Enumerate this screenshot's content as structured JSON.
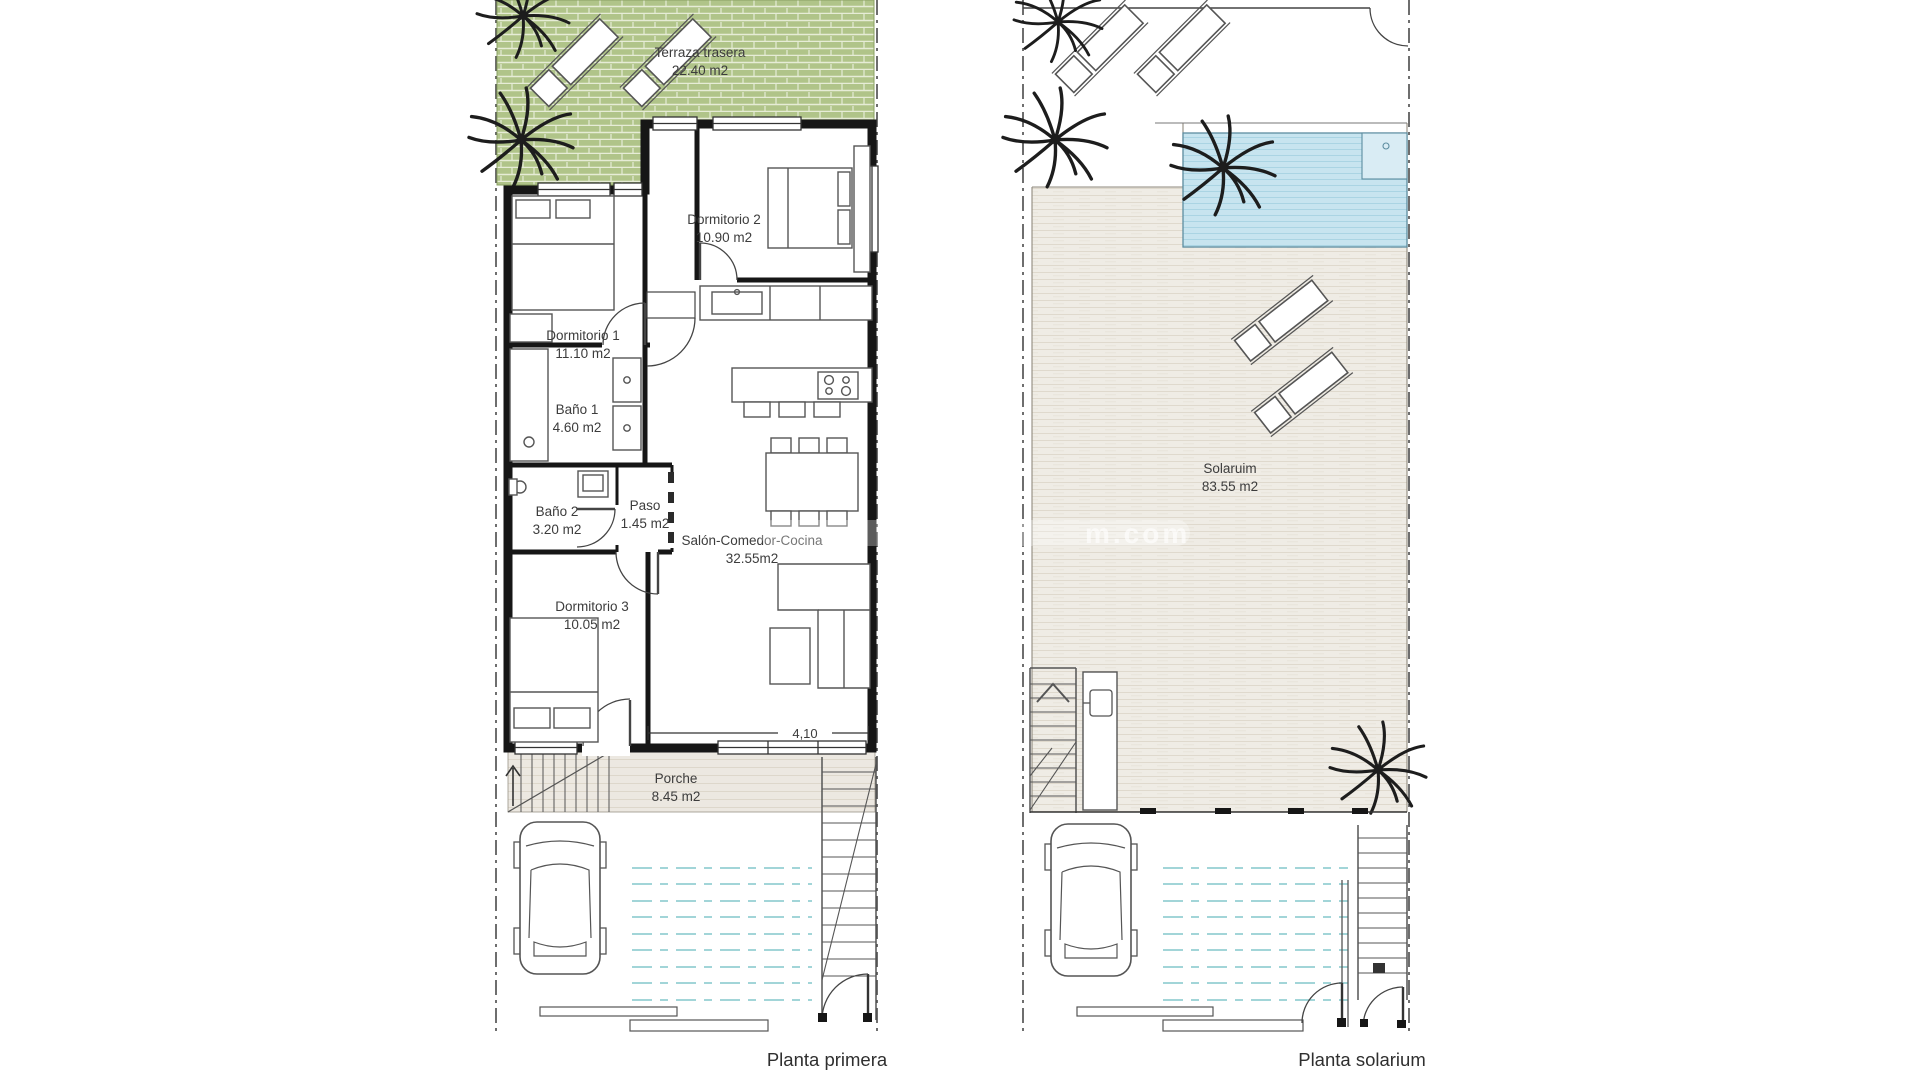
{
  "document": {
    "type": "architectural floor plan",
    "plans_count": 2
  },
  "plans": {
    "left": {
      "caption": "Planta primera",
      "dimension": "4,10",
      "rooms": [
        {
          "name": "Terraza trasera",
          "area": "22.40 m2"
        },
        {
          "name": "Dormitorio 2",
          "area": "10.90 m2"
        },
        {
          "name": "Dormitorio 1",
          "area": "11.10 m2"
        },
        {
          "name": "Baño 1",
          "area": "4.60 m2"
        },
        {
          "name": "Baño 2",
          "area": "3.20 m2"
        },
        {
          "name": "Paso",
          "area": "1.45 m2"
        },
        {
          "name": "Salón-Comedor-Cocina",
          "area": "32.55m2"
        },
        {
          "name": "Dormitorio 3",
          "area": "10.05 m2"
        },
        {
          "name": "Porche",
          "area": "8.45 m2"
        }
      ]
    },
    "right": {
      "caption": "Planta solarium",
      "rooms": [
        {
          "name": "Solaruim",
          "area": "83.55 m2"
        }
      ]
    }
  },
  "watermark": {
    "fragment": "m.com"
  },
  "colors": {
    "terrace_green": "#b0c489",
    "pool_blue": "#c7e4ef",
    "solarium_beige": "#efece5",
    "porch_beige": "#ece8e1",
    "driveway_cyan": "#a2d5d8",
    "wall_black": "#161616"
  }
}
